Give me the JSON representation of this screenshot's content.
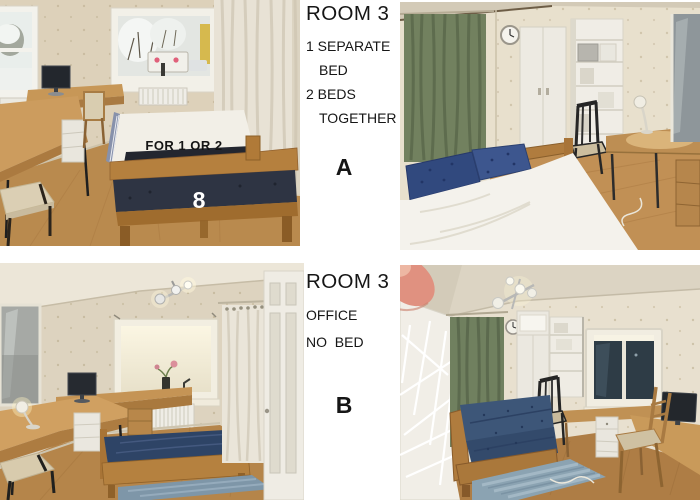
{
  "captions": {
    "top": {
      "title": "ROOM 3",
      "line1": "1 SEPARATE",
      "line2": "BED",
      "line3": "2 BEDS",
      "line4": "TOGETHER",
      "option": "A"
    },
    "bottom": {
      "title": "ROOM 3",
      "line1": "OFFICE",
      "line2": "NO  BED",
      "option": "B"
    }
  },
  "overlays": {
    "top_left_photo": {
      "capacity_text": "FOR 1 OR 2",
      "bed_number": "8"
    }
  },
  "palette": {
    "background": "#ffffff",
    "caption_text": "#161616",
    "overlay_text_dark": "#151515",
    "overlay_text_light": "#ffffff",
    "wall_beige": "#ddd2bd",
    "floor_wood": "#b5834a",
    "furniture_wood": "#bb8c51",
    "mattress_navy": "#2e3443",
    "pillow_navy": "#35508a",
    "curtain_green": "#70805f",
    "curtain_cream": "#e8e2d5",
    "rug_blue": "#8ba3b2",
    "finger_pink": "#e09180"
  }
}
